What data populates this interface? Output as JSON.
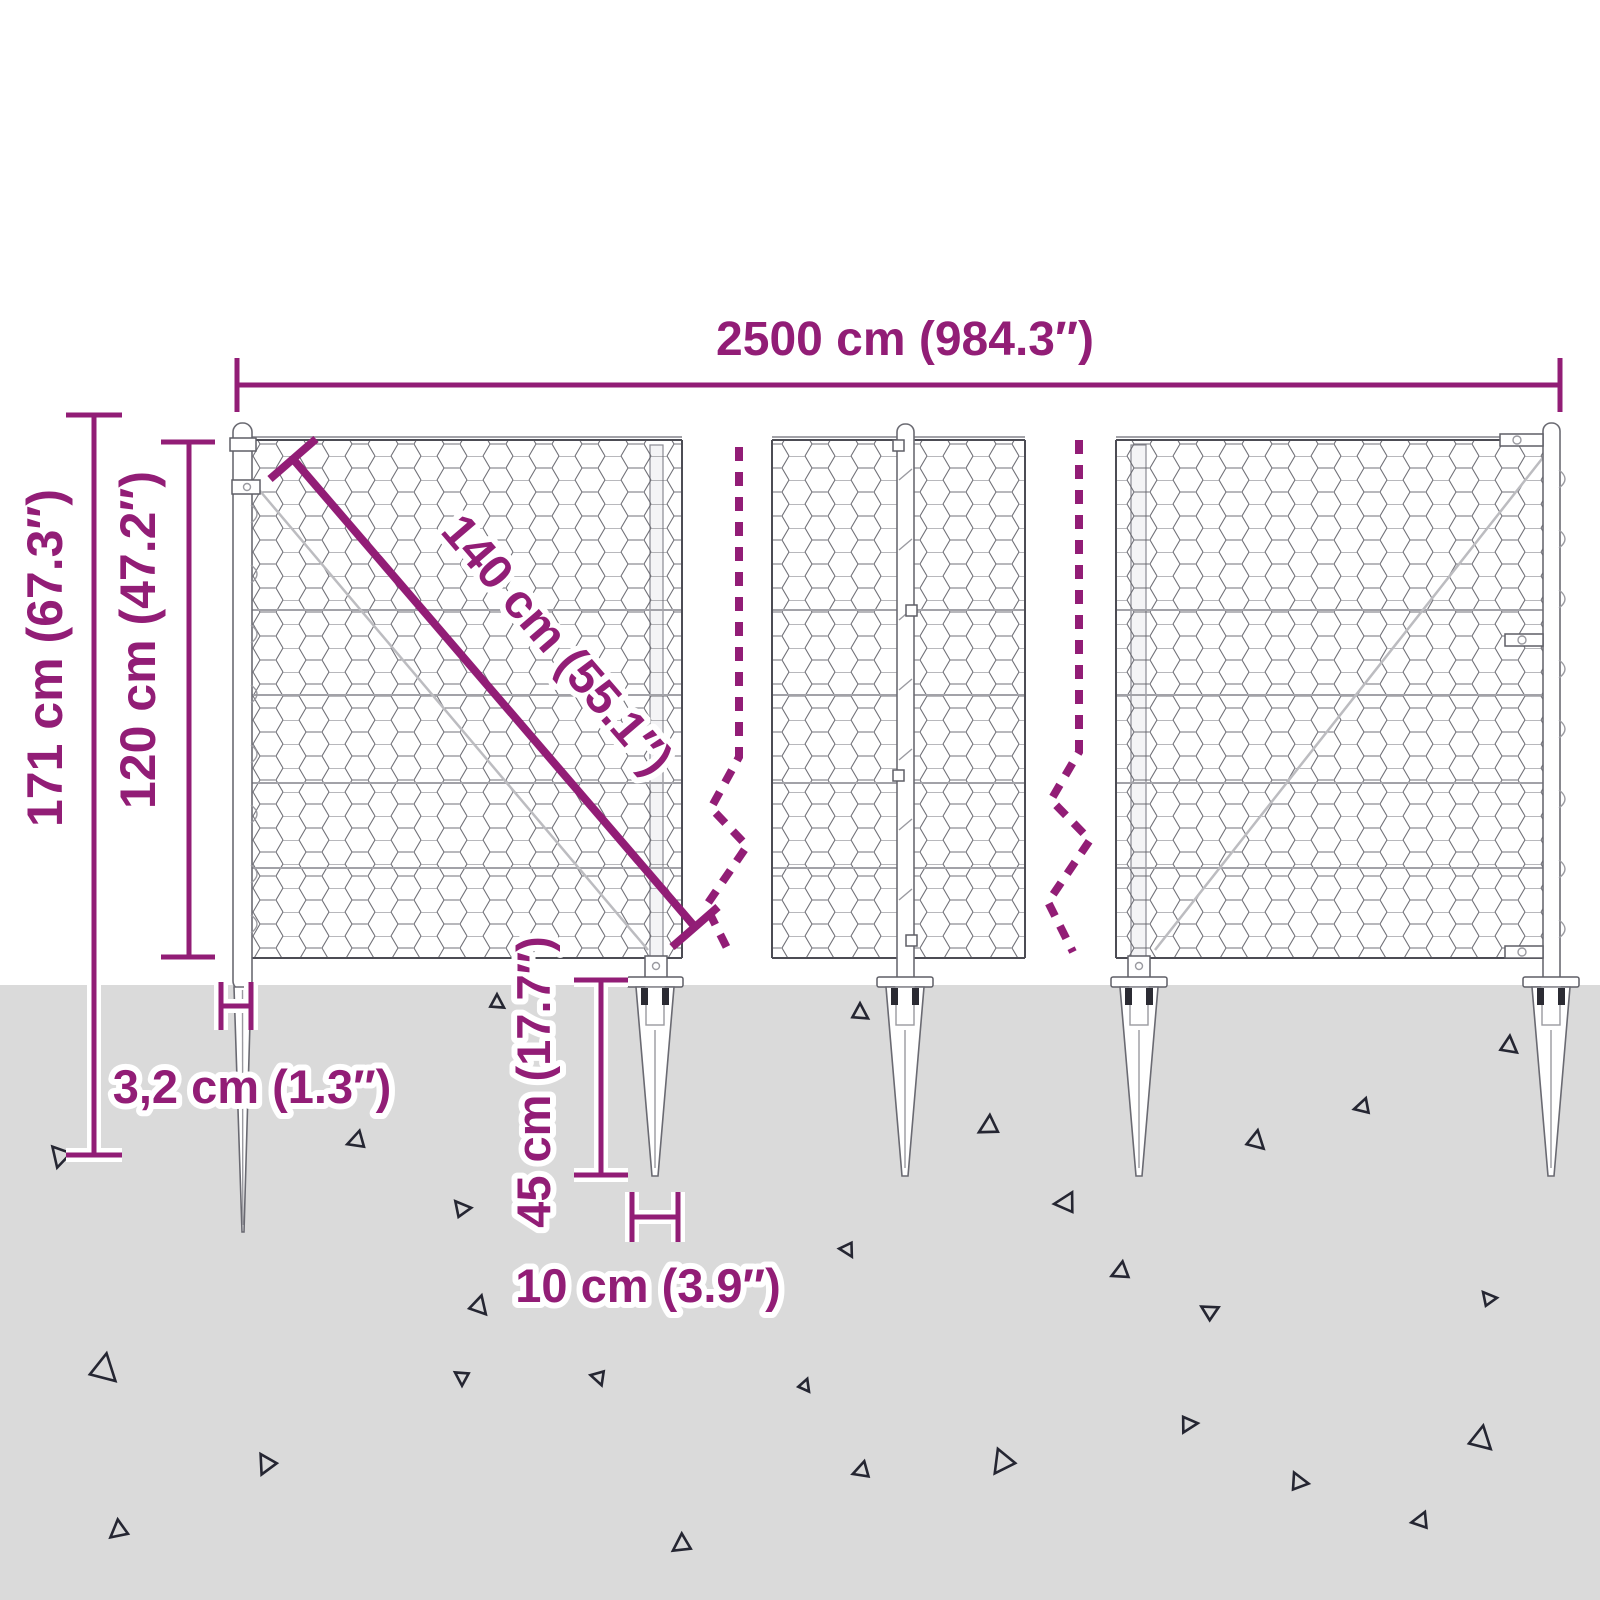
{
  "diagram": {
    "title": "chain-link-fence-with-spike-anchors-dimension-diagram",
    "dimensions": {
      "total_width": "2500 cm (984.3″)",
      "total_height": "171 cm (67.3″)",
      "fence_height": "120 cm (47.2″)",
      "mesh_diagonal": "140 cm (55.1″)",
      "post_width": "3,2 cm (1.3″)",
      "spike_depth": "45 cm (17.7″)",
      "spike_width": "10 cm (3.9″)"
    },
    "colors": {
      "dimension_purple": "#921d76",
      "ground_gray": "#dadada",
      "fence_line": "#55555c",
      "debris_dark": "#252632",
      "background": "#ffffff"
    },
    "ground_debris": [
      [
        60,
        1157,
        1.0,
        195
      ],
      [
        497,
        1002,
        0.7,
        0
      ],
      [
        356,
        1141,
        0.85,
        250
      ],
      [
        461,
        1208,
        0.8,
        320
      ],
      [
        479,
        1305,
        0.9,
        15
      ],
      [
        104,
        1368,
        1.35,
        10
      ],
      [
        266,
        1465,
        0.95,
        205
      ],
      [
        118,
        1531,
        0.9,
        230
      ],
      [
        462,
        1378,
        0.7,
        180
      ],
      [
        599,
        1378,
        0.7,
        160
      ],
      [
        681,
        1545,
        0.9,
        235
      ],
      [
        860,
        1012,
        0.8,
        0
      ],
      [
        988,
        1127,
        0.95,
        240
      ],
      [
        1065,
        1203,
        1.0,
        265
      ],
      [
        1120,
        1272,
        0.85,
        245
      ],
      [
        848,
        1250,
        0.7,
        150
      ],
      [
        1256,
        1140,
        0.9,
        10
      ],
      [
        1362,
        1107,
        0.75,
        255
      ],
      [
        1509,
        1045,
        0.85,
        5
      ],
      [
        805,
        1385,
        0.6,
        20
      ],
      [
        861,
        1471,
        0.8,
        250
      ],
      [
        1002,
        1463,
        1.15,
        215
      ],
      [
        1189,
        1424,
        0.8,
        85
      ],
      [
        1298,
        1481,
        0.85,
        335
      ],
      [
        1420,
        1521,
        0.8,
        260
      ],
      [
        1481,
        1438,
        1.15,
        10
      ],
      [
        1209,
        1311,
        0.8,
        300
      ],
      [
        1488,
        1298,
        0.7,
        320
      ]
    ]
  }
}
